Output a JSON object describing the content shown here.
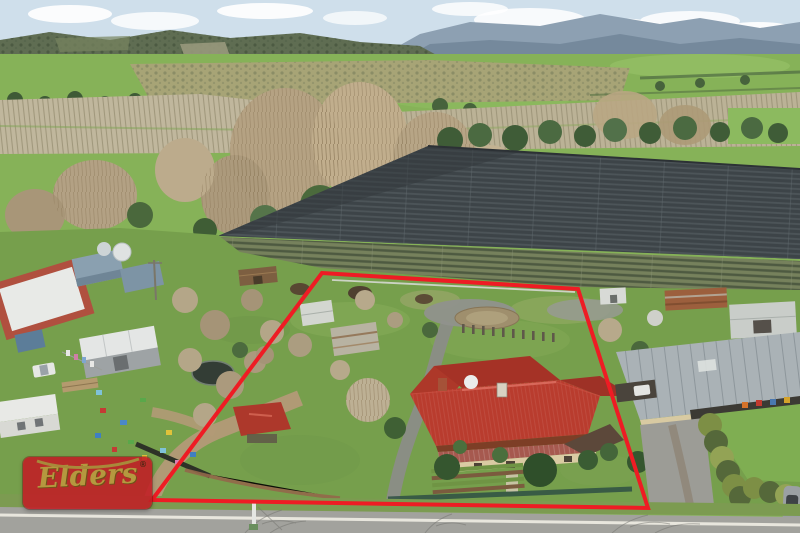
{
  "scene": {
    "description": "Aerial drone photograph of a rural homestead property outlined with a red boundary overlay; netted berry farm and hills behind, neighbouring sheds either side, road in foreground"
  },
  "watermark": {
    "brand": "Elders",
    "registered_mark": "®"
  },
  "overlay": {
    "boundary_points": "322,273 578,289 648,508 152,500",
    "boundary_color": "#ee1c24",
    "boundary_stroke_width": "4"
  },
  "palette": {
    "sky_blue": "#cfdfeb",
    "mountain_blue": "#75899c",
    "forest_hill": "#5f6d52",
    "field_green": "#86b258",
    "netting_gray": "#3d4448",
    "vineyard_green": "#76815c",
    "grass_green": "#769f4c",
    "roof_red": "#b93c2e",
    "road_gray": "#a2a29d",
    "brand_red": "#c21d24",
    "brand_gold": "#b5983f"
  }
}
